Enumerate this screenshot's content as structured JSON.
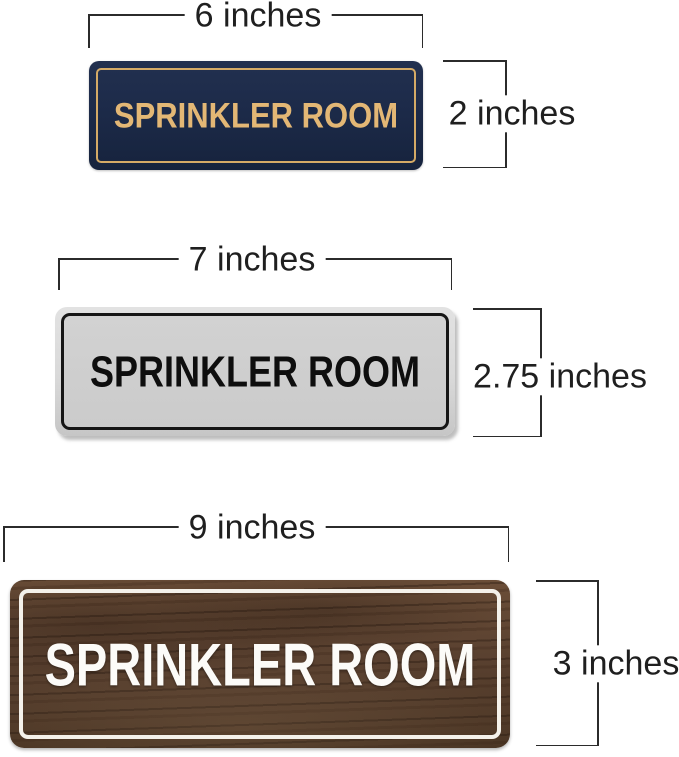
{
  "image_type": "product-dimension-diagram",
  "annotation": {
    "color": "#1f1f1f",
    "line_color": "#2b2b2b"
  },
  "signs": [
    {
      "name": "navy-gold-sign",
      "text": "SPRINKLER ROOM",
      "width_label": "6 inches",
      "height_label": "2 inches",
      "colors": {
        "plate": "#1d2b4a",
        "border": "#d4aa66",
        "text": "#e3b775"
      }
    },
    {
      "name": "silver-black-sign",
      "text": "SPRINKLER ROOM",
      "width_label": "7 inches",
      "height_label": "2.75 inches",
      "colors": {
        "plate": "#d9d9d9",
        "panel": "#cbcbcb",
        "border": "#161616",
        "text": "#0e0e0e"
      }
    },
    {
      "name": "walnut-wood-sign",
      "text": "SPRINKLER ROOM",
      "width_label": "9 inches",
      "height_label": "3 inches",
      "colors": {
        "plate": "#5a4130",
        "border": "#f4f1ea",
        "text": "#fcfbf8"
      }
    }
  ]
}
